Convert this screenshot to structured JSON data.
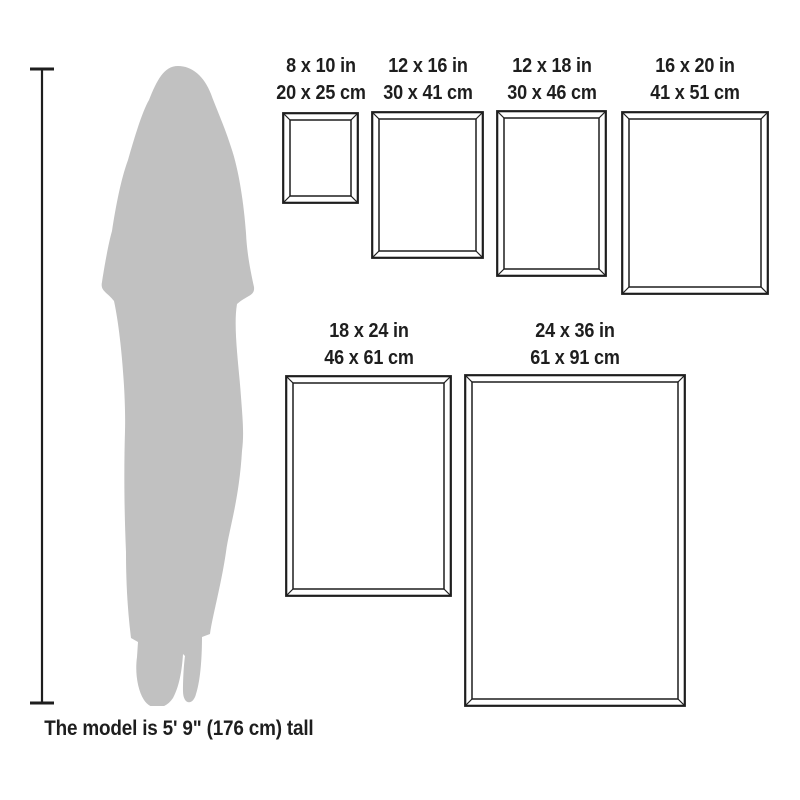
{
  "colors": {
    "ink": "#1e1e1e",
    "silhouette": "#c1c1c1",
    "background": "#ffffff"
  },
  "caption": "The model is 5' 9\" (176 cm) tall",
  "model_height": {
    "feet_inches": "5' 9\"",
    "cm": "176 cm"
  },
  "frames": [
    {
      "id": "8x10",
      "inches": "8 x 10 in",
      "cm": "20 x 25 cm"
    },
    {
      "id": "12x16",
      "inches": "12 x 16 in",
      "cm": "30 x 41 cm"
    },
    {
      "id": "12x18",
      "inches": "12 x 18 in",
      "cm": "30 x 46 cm"
    },
    {
      "id": "16x20",
      "inches": "16 x 20 in",
      "cm": "41 x 51 cm"
    },
    {
      "id": "18x24",
      "inches": "18 x 24 in",
      "cm": "46 x 61 cm"
    },
    {
      "id": "24x36",
      "inches": "24 x 36 in",
      "cm": "61 x 91 cm"
    }
  ]
}
